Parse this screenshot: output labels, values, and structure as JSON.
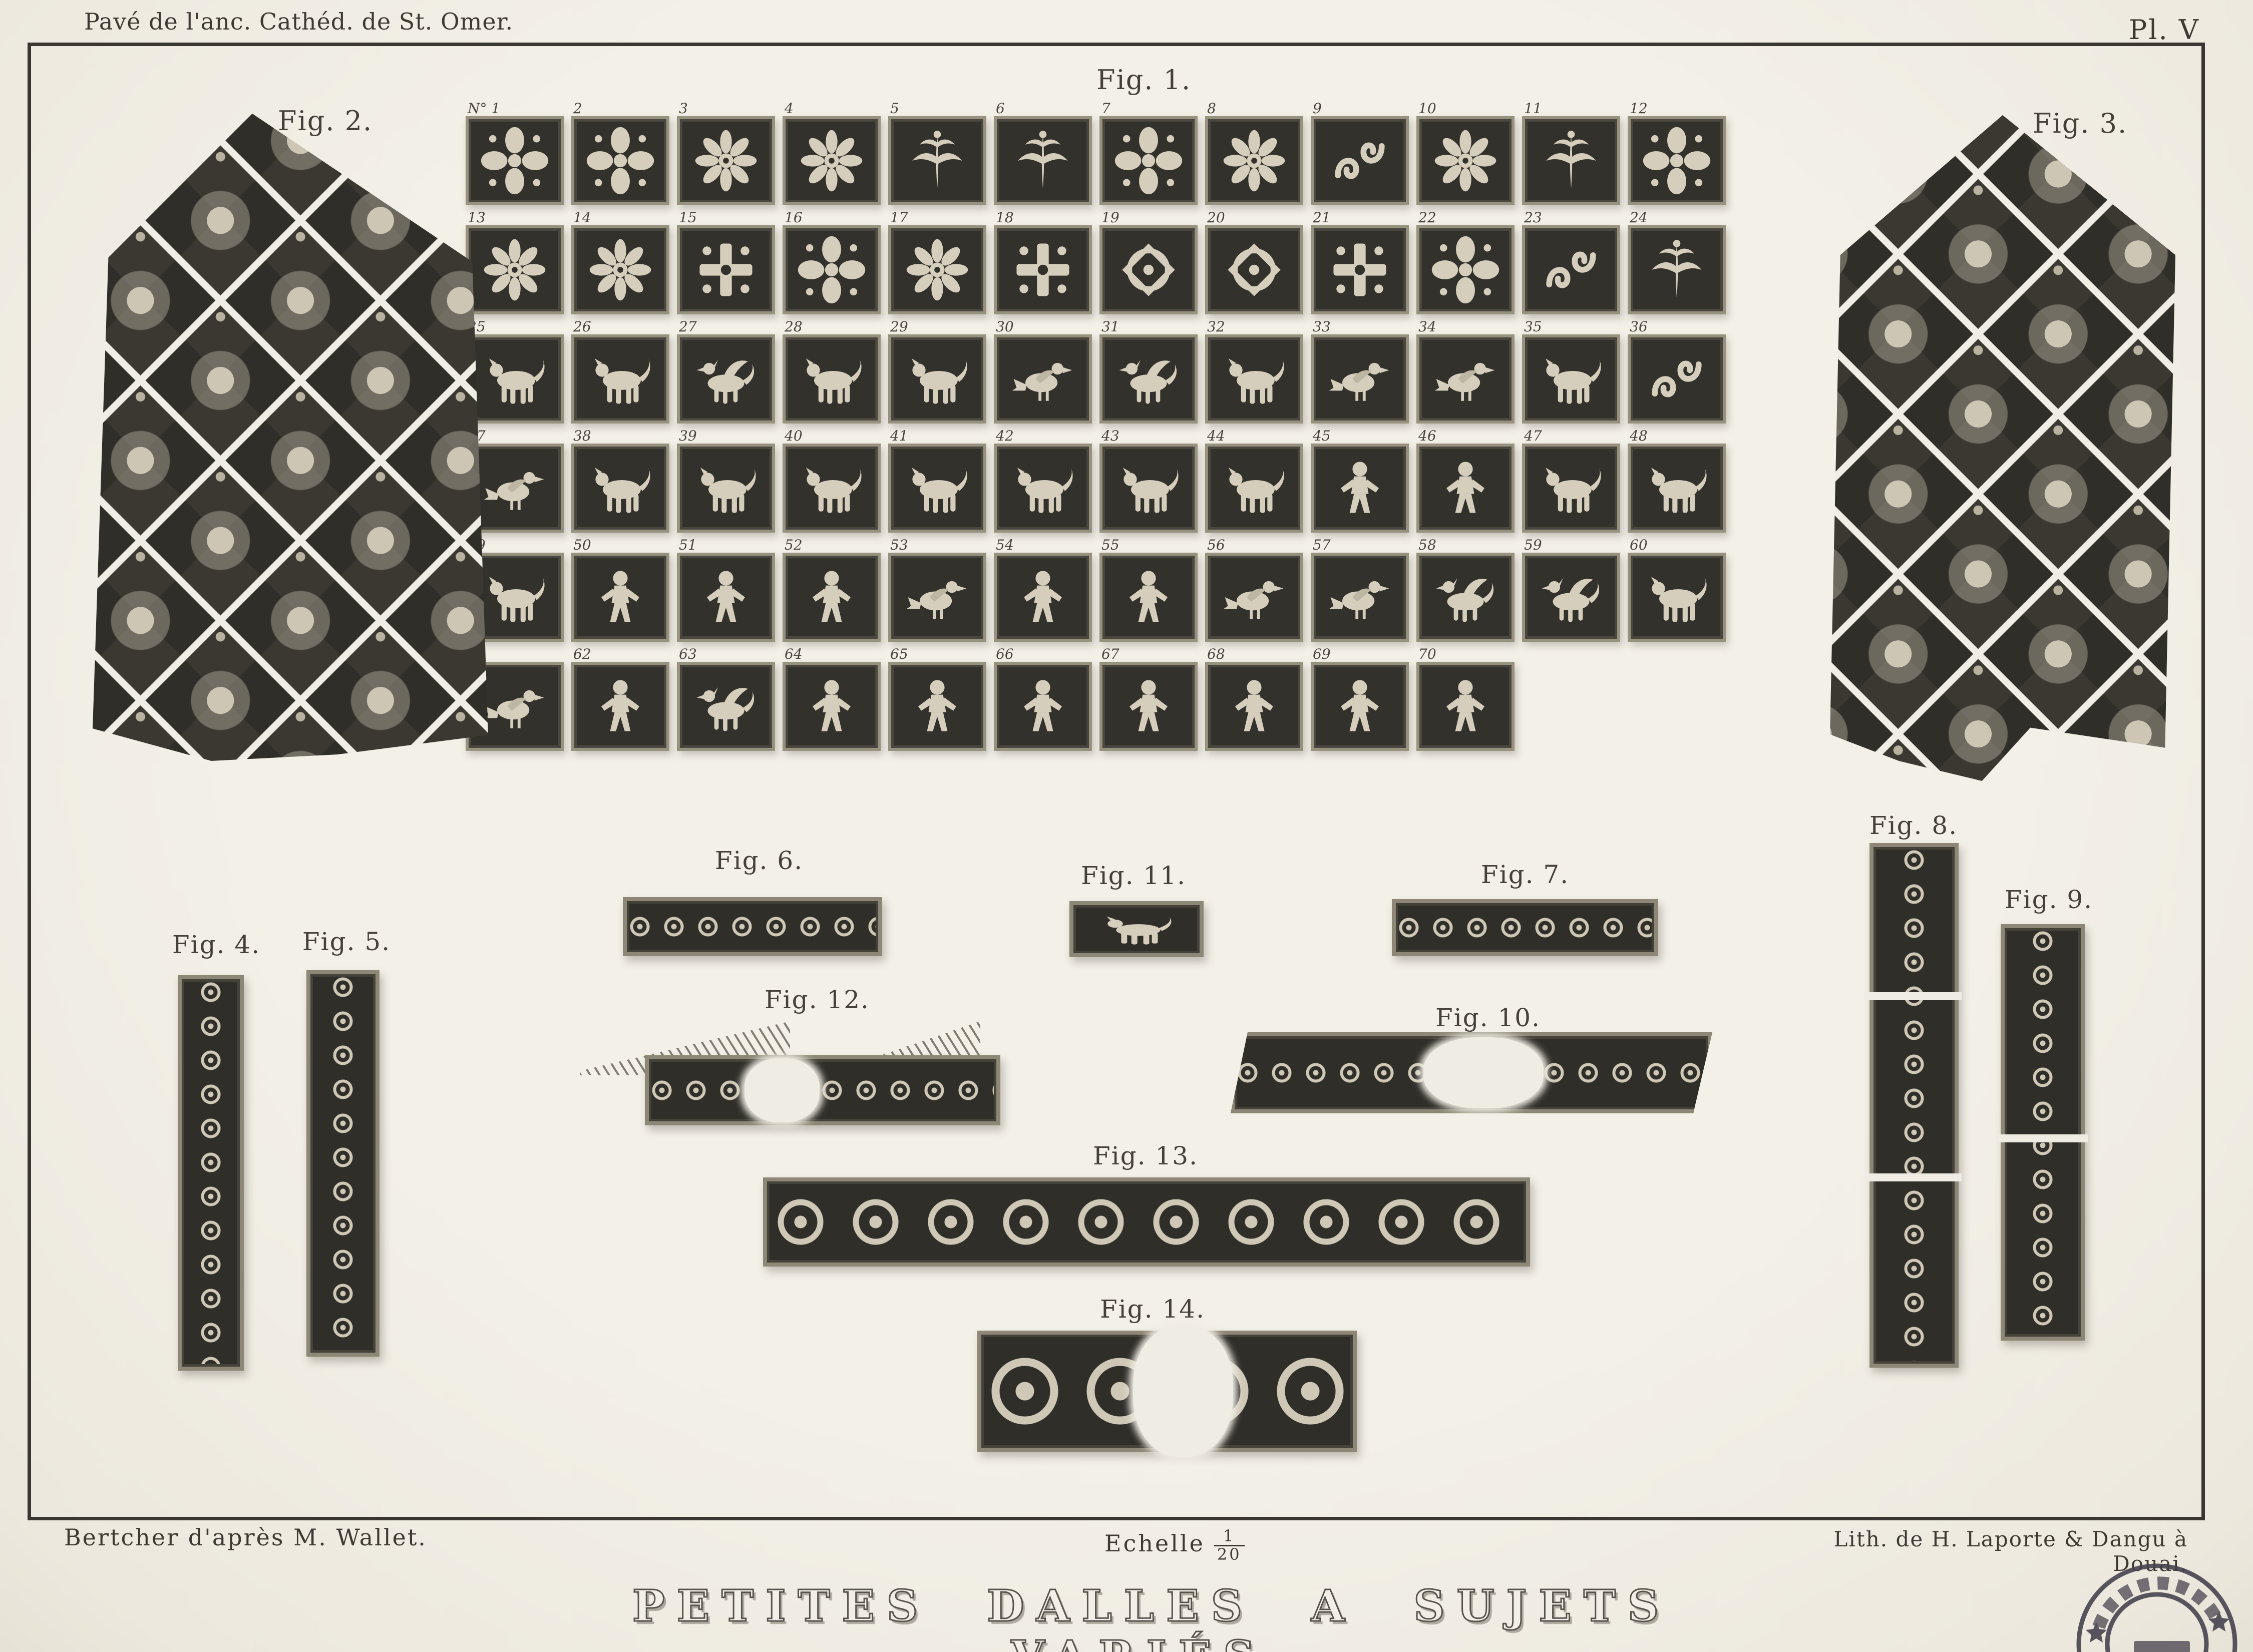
{
  "header": {
    "caption_left": "Pavé de l'anc. Cathéd. de St. Omer.",
    "plate_number": "Pl. V"
  },
  "fig1": {
    "label": "Fig. 1.",
    "tiles": [
      {
        "n": "N° 1",
        "motif": "quatrefoil"
      },
      {
        "n": "2",
        "motif": "quatrefoil"
      },
      {
        "n": "3",
        "motif": "rosette"
      },
      {
        "n": "4",
        "motif": "rosette"
      },
      {
        "n": "5",
        "motif": "leaf"
      },
      {
        "n": "6",
        "motif": "leaf"
      },
      {
        "n": "7",
        "motif": "quatrefoil"
      },
      {
        "n": "8",
        "motif": "rosette"
      },
      {
        "n": "9",
        "motif": "scroll"
      },
      {
        "n": "10",
        "motif": "rosette"
      },
      {
        "n": "11",
        "motif": "leaf"
      },
      {
        "n": "12",
        "motif": "quatrefoil"
      },
      {
        "n": "13",
        "motif": "rosette"
      },
      {
        "n": "14",
        "motif": "rosette"
      },
      {
        "n": "15",
        "motif": "cross"
      },
      {
        "n": "16",
        "motif": "quatrefoil"
      },
      {
        "n": "17",
        "motif": "rosette"
      },
      {
        "n": "18",
        "motif": "cross"
      },
      {
        "n": "19",
        "motif": "knot"
      },
      {
        "n": "20",
        "motif": "knot"
      },
      {
        "n": "21",
        "motif": "cross"
      },
      {
        "n": "22",
        "motif": "quatrefoil"
      },
      {
        "n": "23",
        "motif": "scroll"
      },
      {
        "n": "24",
        "motif": "leaf"
      },
      {
        "n": "25",
        "motif": "beast"
      },
      {
        "n": "26",
        "motif": "beast"
      },
      {
        "n": "27",
        "motif": "griffin"
      },
      {
        "n": "28",
        "motif": "beast"
      },
      {
        "n": "29",
        "motif": "beast"
      },
      {
        "n": "30",
        "motif": "bird"
      },
      {
        "n": "31",
        "motif": "griffin"
      },
      {
        "n": "32",
        "motif": "beast"
      },
      {
        "n": "33",
        "motif": "bird"
      },
      {
        "n": "34",
        "motif": "bird"
      },
      {
        "n": "35",
        "motif": "beast"
      },
      {
        "n": "36",
        "motif": "scroll"
      },
      {
        "n": "37",
        "motif": "bird"
      },
      {
        "n": "38",
        "motif": "beast"
      },
      {
        "n": "39",
        "motif": "beast"
      },
      {
        "n": "40",
        "motif": "beast"
      },
      {
        "n": "41",
        "motif": "beast"
      },
      {
        "n": "42",
        "motif": "beast"
      },
      {
        "n": "43",
        "motif": "beast"
      },
      {
        "n": "44",
        "motif": "beast"
      },
      {
        "n": "45",
        "motif": "figure"
      },
      {
        "n": "46",
        "motif": "figure"
      },
      {
        "n": "47",
        "motif": "beast"
      },
      {
        "n": "48",
        "motif": "beast"
      },
      {
        "n": "49",
        "motif": "beast"
      },
      {
        "n": "50",
        "motif": "figure"
      },
      {
        "n": "51",
        "motif": "figure"
      },
      {
        "n": "52",
        "motif": "figure"
      },
      {
        "n": "53",
        "motif": "bird"
      },
      {
        "n": "54",
        "motif": "figure"
      },
      {
        "n": "55",
        "motif": "figure"
      },
      {
        "n": "56",
        "motif": "bird"
      },
      {
        "n": "57",
        "motif": "bird"
      },
      {
        "n": "58",
        "motif": "griffin"
      },
      {
        "n": "59",
        "motif": "griffin"
      },
      {
        "n": "60",
        "motif": "beast"
      },
      {
        "n": "61",
        "motif": "bird"
      },
      {
        "n": "62",
        "motif": "figure"
      },
      {
        "n": "63",
        "motif": "griffin"
      },
      {
        "n": "64",
        "motif": "figure"
      },
      {
        "n": "65",
        "motif": "figure"
      },
      {
        "n": "66",
        "motif": "figure"
      },
      {
        "n": "67",
        "motif": "figure"
      },
      {
        "n": "68",
        "motif": "figure"
      },
      {
        "n": "69",
        "motif": "figure"
      },
      {
        "n": "70",
        "motif": "figure"
      }
    ]
  },
  "fig2": {
    "label": "Fig. 2.",
    "numbers": [
      {
        "t": "N° 71",
        "x": "38%",
        "y": "0%"
      },
      {
        "t": "72",
        "x": "7%",
        "y": "13%"
      },
      {
        "t": "73",
        "x": "60%",
        "y": "13%"
      },
      {
        "t": "74",
        "x": "43%",
        "y": "24%"
      },
      {
        "t": "75",
        "x": "9%",
        "y": "33%"
      },
      {
        "t": "76",
        "x": "60%",
        "y": "33%"
      },
      {
        "t": "98",
        "x": "82%",
        "y": "34%"
      },
      {
        "t": "91",
        "x": "1%",
        "y": "35%"
      },
      {
        "t": "77",
        "x": "43%",
        "y": "42%"
      },
      {
        "t": "78",
        "x": "25%",
        "y": "49%"
      },
      {
        "t": "79",
        "x": "61%",
        "y": "49%"
      },
      {
        "t": "92",
        "x": "1%",
        "y": "57%"
      },
      {
        "t": "97",
        "x": "84%",
        "y": "57%"
      },
      {
        "t": "80",
        "x": "47%",
        "y": "58%"
      },
      {
        "t": "93",
        "x": "3%",
        "y": "78%"
      },
      {
        "t": "96",
        "x": "84%",
        "y": "78%"
      },
      {
        "t": "94",
        "x": "30%",
        "y": "93%"
      },
      {
        "t": "95",
        "x": "52%",
        "y": "93%"
      }
    ]
  },
  "fig3": {
    "label": "Fig. 3.",
    "numbers": [
      {
        "t": "N° 81",
        "x": "43%",
        "y": "1%"
      },
      {
        "t": "82",
        "x": "36%",
        "y": "13%"
      },
      {
        "t": "83",
        "x": "55%",
        "y": "12%"
      },
      {
        "t": "84",
        "x": "61%",
        "y": "24%"
      },
      {
        "t": "99",
        "x": "6%",
        "y": "35%"
      },
      {
        "t": "85",
        "x": "38%",
        "y": "36%"
      },
      {
        "t": "106",
        "x": "90%",
        "y": "35%"
      },
      {
        "t": "86",
        "x": "60%",
        "y": "47%"
      },
      {
        "t": "100",
        "x": "6%",
        "y": "57%"
      },
      {
        "t": "87",
        "x": "38%",
        "y": "58%"
      },
      {
        "t": "105",
        "x": "90%",
        "y": "57%"
      },
      {
        "t": "88",
        "x": "60%",
        "y": "69%"
      },
      {
        "t": "101",
        "x": "8%",
        "y": "78%"
      },
      {
        "t": "89",
        "x": "38%",
        "y": "80%"
      },
      {
        "t": "104",
        "x": "70%",
        "y": "80%"
      },
      {
        "t": "102",
        "x": "8%",
        "y": "87%"
      },
      {
        "t": "103",
        "x": "51%",
        "y": "94%"
      }
    ]
  },
  "fig_labels": {
    "fig4": "Fig. 4.",
    "fig5": "Fig. 5.",
    "fig6": "Fig. 6.",
    "fig7": "Fig. 7.",
    "fig8": "Fig. 8.",
    "fig9": "Fig. 9.",
    "fig10": "Fig. 10.",
    "fig11": "Fig. 11.",
    "fig12": "Fig. 12.",
    "fig13": "Fig. 13.",
    "fig14": "Fig. 14."
  },
  "footer": {
    "credit_left": "Bertcher d'après M. Wallet.",
    "scale_label": "Echelle",
    "scale_numerator": "1",
    "scale_denominator": "20",
    "credit_right": "Lith. de H. Laporte & Dangu à Douai.",
    "title": "PETITES DALLES A SUJETS VARIÉS."
  },
  "stamp": {
    "type": "circular-ink-stamp",
    "legible": false
  },
  "colors": {
    "paper": "#f1eee6",
    "ink_dark": "#33312c",
    "ornament_light": "#d5cebc",
    "stamp_ink": "#433f4b"
  }
}
